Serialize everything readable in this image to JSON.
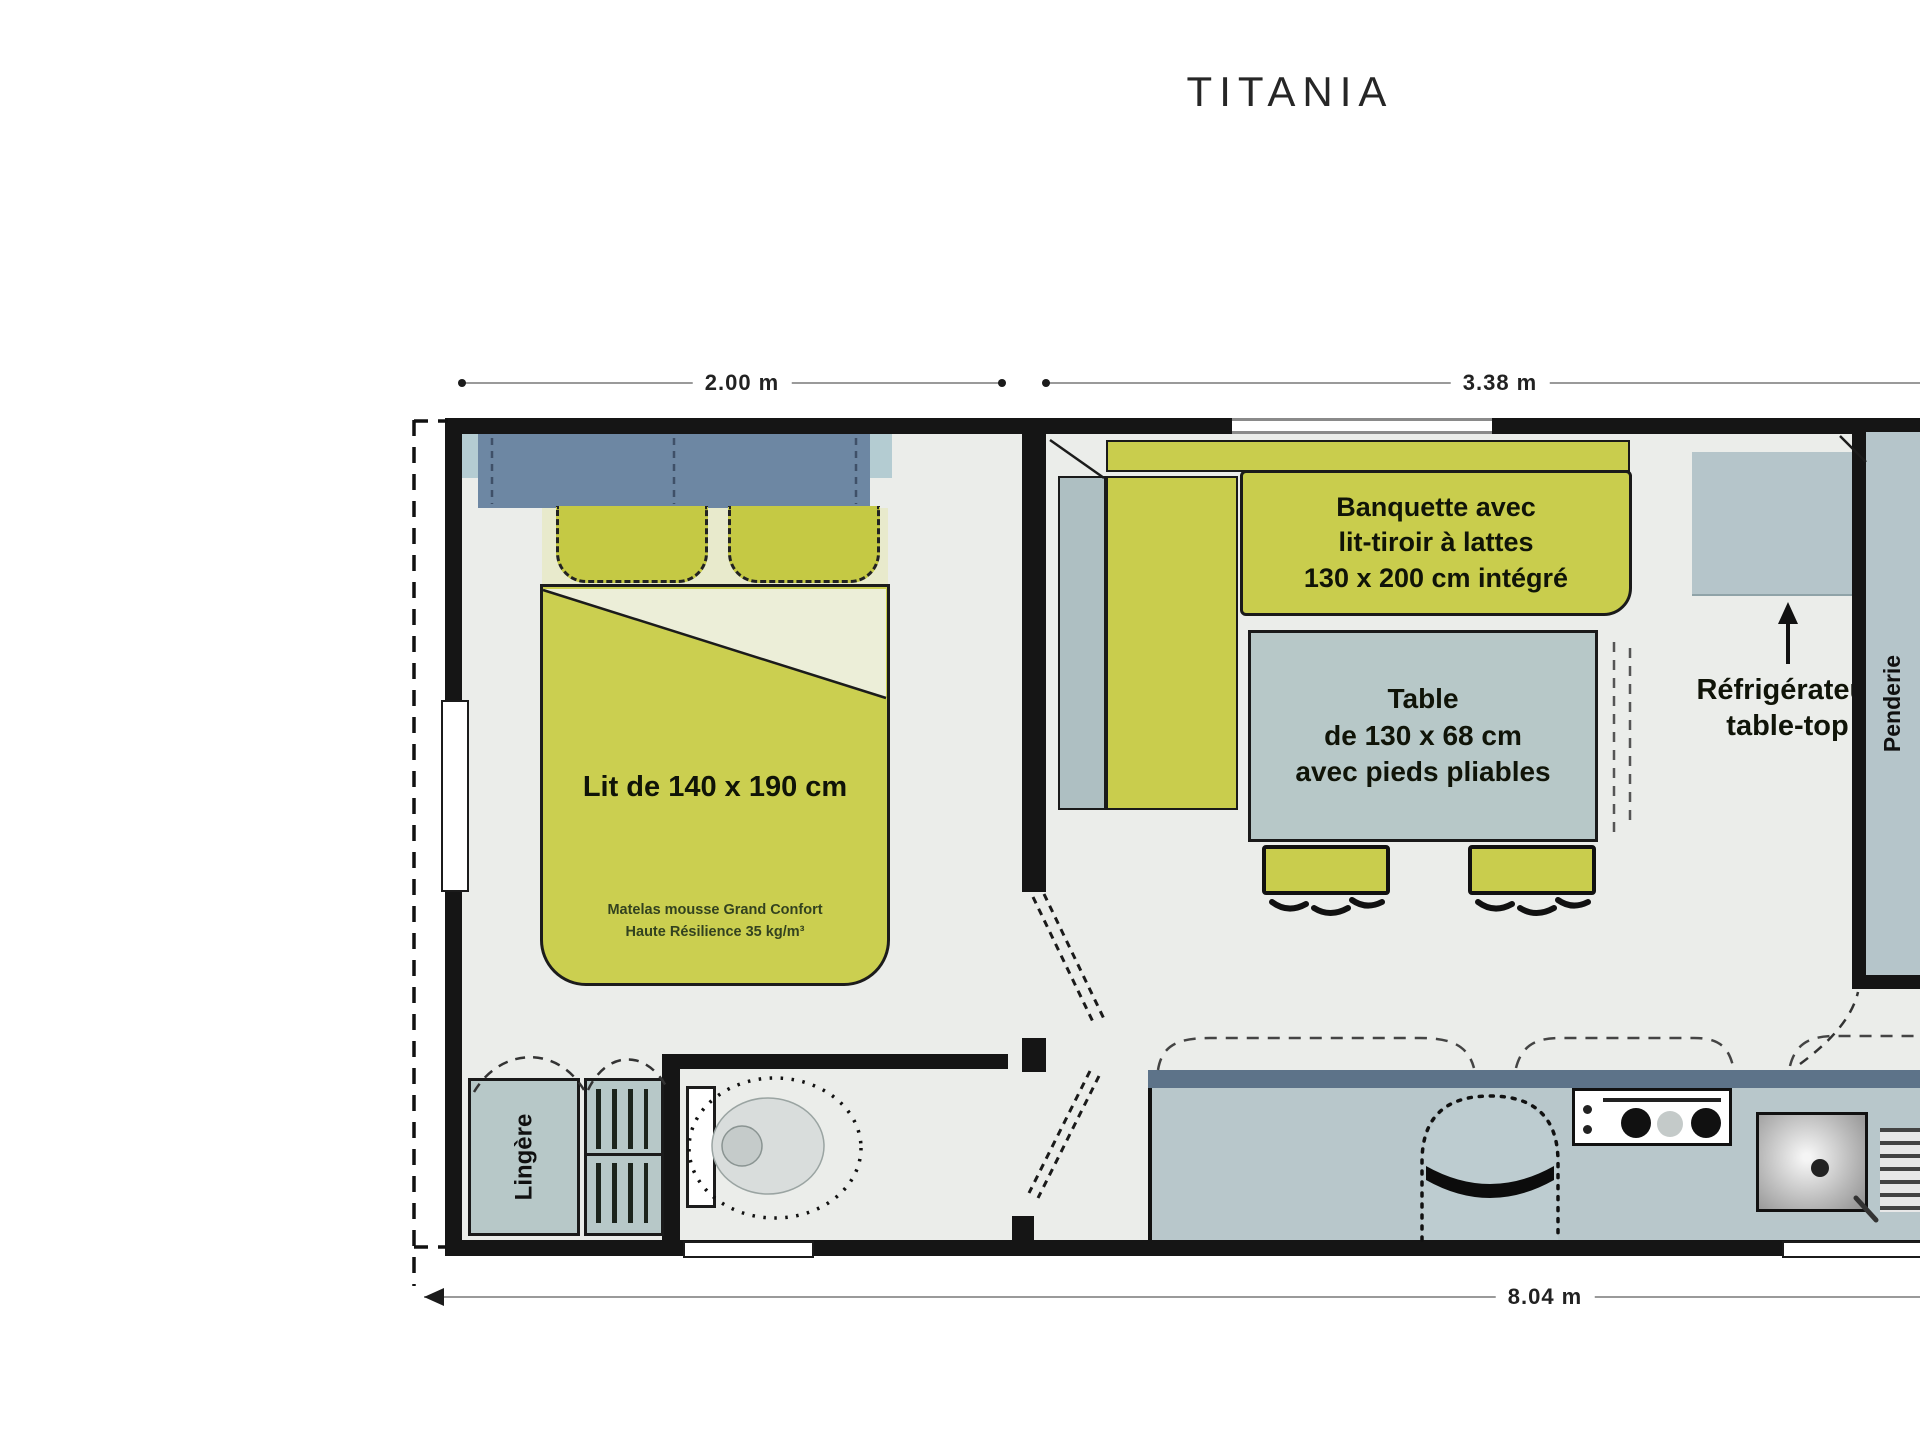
{
  "title": "TITANIA",
  "dimensions": {
    "bedroom_width": "2.00 m",
    "living_width": "3.38 m",
    "total_length": "8.04 m"
  },
  "bedroom": {
    "bed_label": "Lit de 140 x 190 cm",
    "mattress_note_line1": "Matelas mousse Grand Confort",
    "mattress_note_line2": "Haute Résilience 35 kg/m³",
    "linen_cabinet_label": "Lingère"
  },
  "living": {
    "banquette_line1": "Banquette avec",
    "banquette_line2": "lit-tiroir à lattes",
    "banquette_line3": "130 x 200 cm intégré",
    "table_line1": "Table",
    "table_line2": "de 130 x 68 cm",
    "table_line3": "avec pieds pliables",
    "fridge_line1": "Réfrigérateur",
    "fridge_line2": "table-top",
    "wardrobe_label": "Penderie"
  },
  "colors": {
    "furniture_green": "#c9cd4d",
    "furniture_green_pale": "#eceed8",
    "cabinet_blue": "#b7c8c8",
    "headboard_blue": "#6d87a3",
    "kitchen_counter_band": "#5d7389",
    "wall_black": "#151515",
    "floor_gray": "#ebedea"
  }
}
